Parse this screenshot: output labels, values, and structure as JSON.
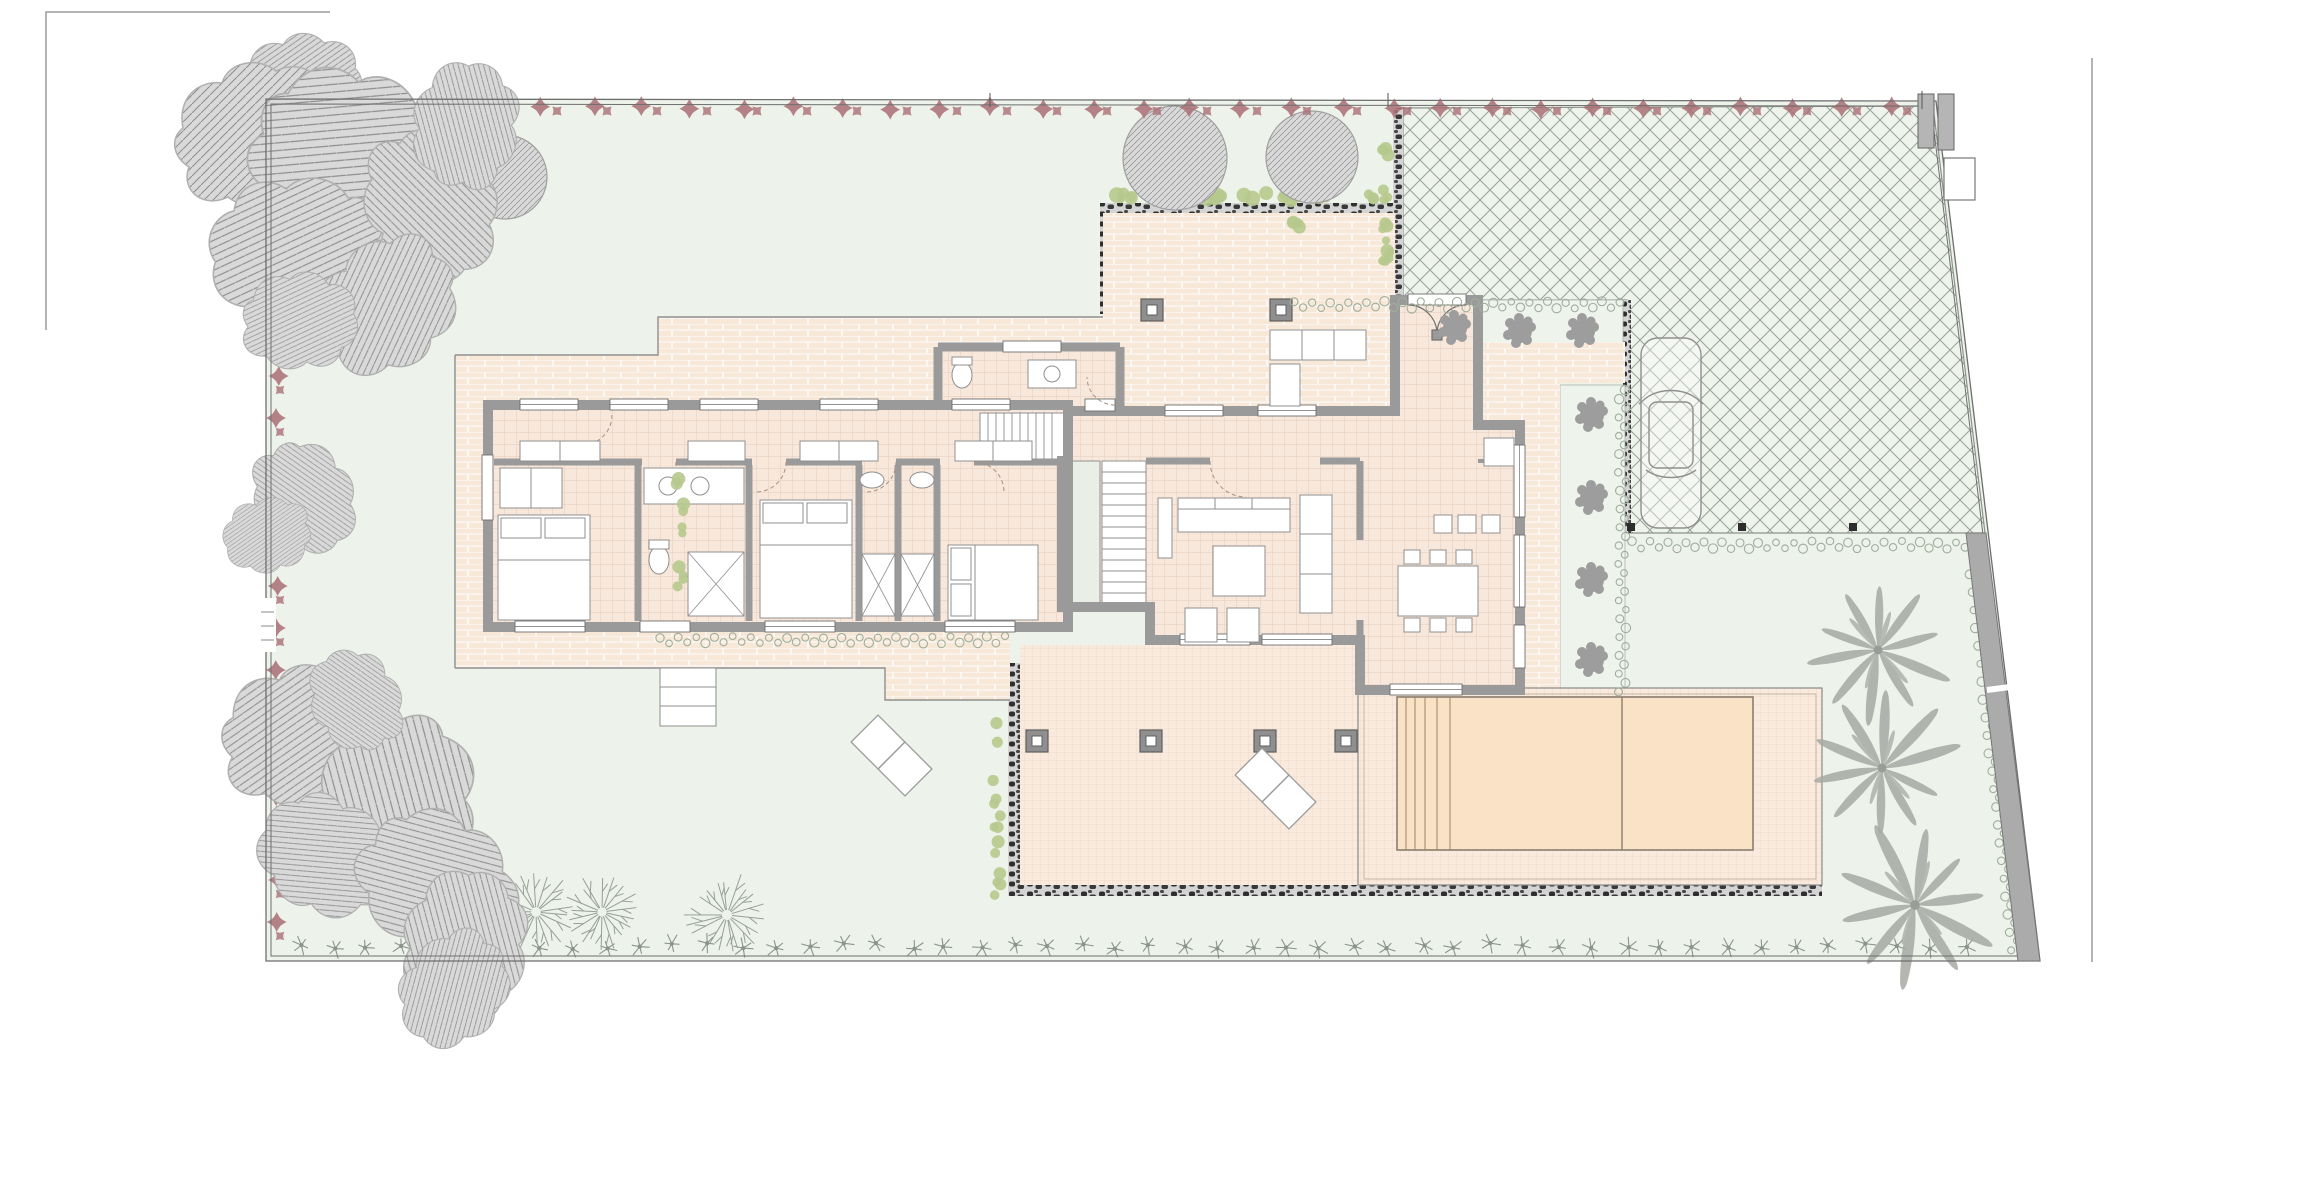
{
  "drawing": {
    "type": "architectural-site-plan",
    "description": "Ground floor site plan of a villa with garden, driveway, terrace and swimming pool",
    "visible_text": ""
  },
  "palette": {
    "paper": "#ffffff",
    "lawn": "#edf2ea",
    "lawn_light": "#eef3ec",
    "tile": "#f8e8db",
    "tile_grid": "#d9b9a6",
    "brick": "#f8e8d7",
    "brick_joint": "#ffffff",
    "deck": "#f9eadd",
    "deck_grid": "#d8b89e",
    "pool": "#f9e2c6",
    "pool_line": "#8a7f6e",
    "wall": "#9a9a9a",
    "wall_dark": "#6f6f6f",
    "stone_base": "#d4d4d4",
    "stone_blob": "#2e2e2e",
    "hedge_red": "#a96e74",
    "shrub_green": "#b6c98d",
    "squiggle": "#9fae9c",
    "tree_gray": "#d9d9d9",
    "tree_hatch": "#8e8e8e",
    "palm": "#a6aaa4",
    "void_green": "#e9efe5",
    "frame": "#9c9c9c",
    "crosshatch_line": "#98a298"
  },
  "features": {
    "bedrooms": 3,
    "bathrooms": 4,
    "guest_wc": 1,
    "living_room": 1,
    "dining_room": 1,
    "kitchen": 1,
    "entrance_vestibule": 1,
    "staircase_flights": 2,
    "swimming_pool": 1,
    "pool_steps": 1,
    "pool_lane_divider": 1,
    "sun_loungers": 2,
    "parked_cars": 1,
    "driveway_paving": "diamond-crosshatch",
    "palm_trees": 3,
    "round_canopy_trees": 3,
    "deciduous_trees": 4,
    "gray_tree_clusters": 3,
    "planting_bed_shrubs": 7,
    "terrace_columns": 4,
    "porch_columns": 2,
    "boundary_hedge_sides": 2,
    "garden_gate": 1
  }
}
